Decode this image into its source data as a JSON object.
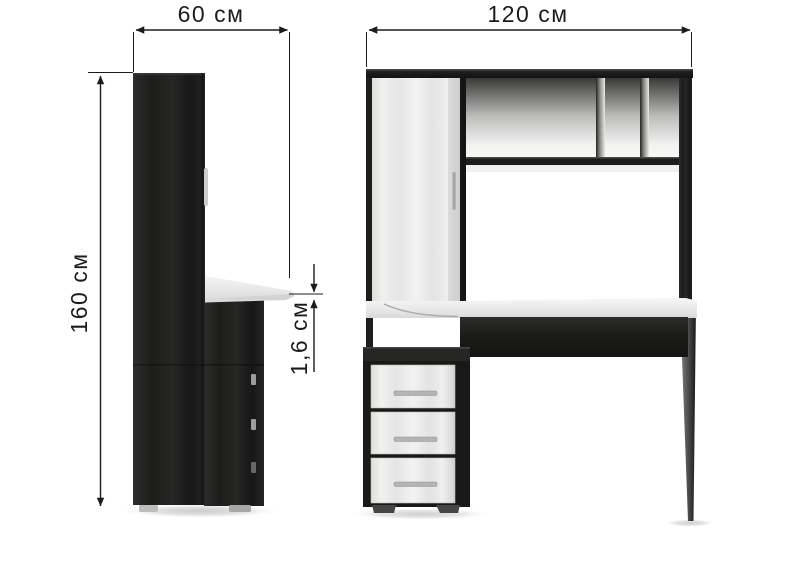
{
  "page": {
    "background": "#ffffff",
    "description": "Furniture dimension diagram: two-tone computer desk (dark wenge and white ash) shown in side view and front view with measurement arrows"
  },
  "dimensions": {
    "depth": {
      "label": "60 см",
      "view": "side-view",
      "orientation": "horizontal"
    },
    "height": {
      "label": "160 см",
      "view": "side-view",
      "orientation": "vertical"
    },
    "thickness": {
      "label": "1,6 см",
      "view": "side-view",
      "orientation": "vertical"
    },
    "width": {
      "label": "120 см",
      "view": "front-view",
      "orientation": "horizontal"
    }
  },
  "colors": {
    "annotation": "#1c1c1c",
    "dark_wood": "#222221",
    "light_wood": "#e9eae9",
    "desktop": "#e6e7e6",
    "handle": "#b3b4b4",
    "background": "#ffffff"
  }
}
